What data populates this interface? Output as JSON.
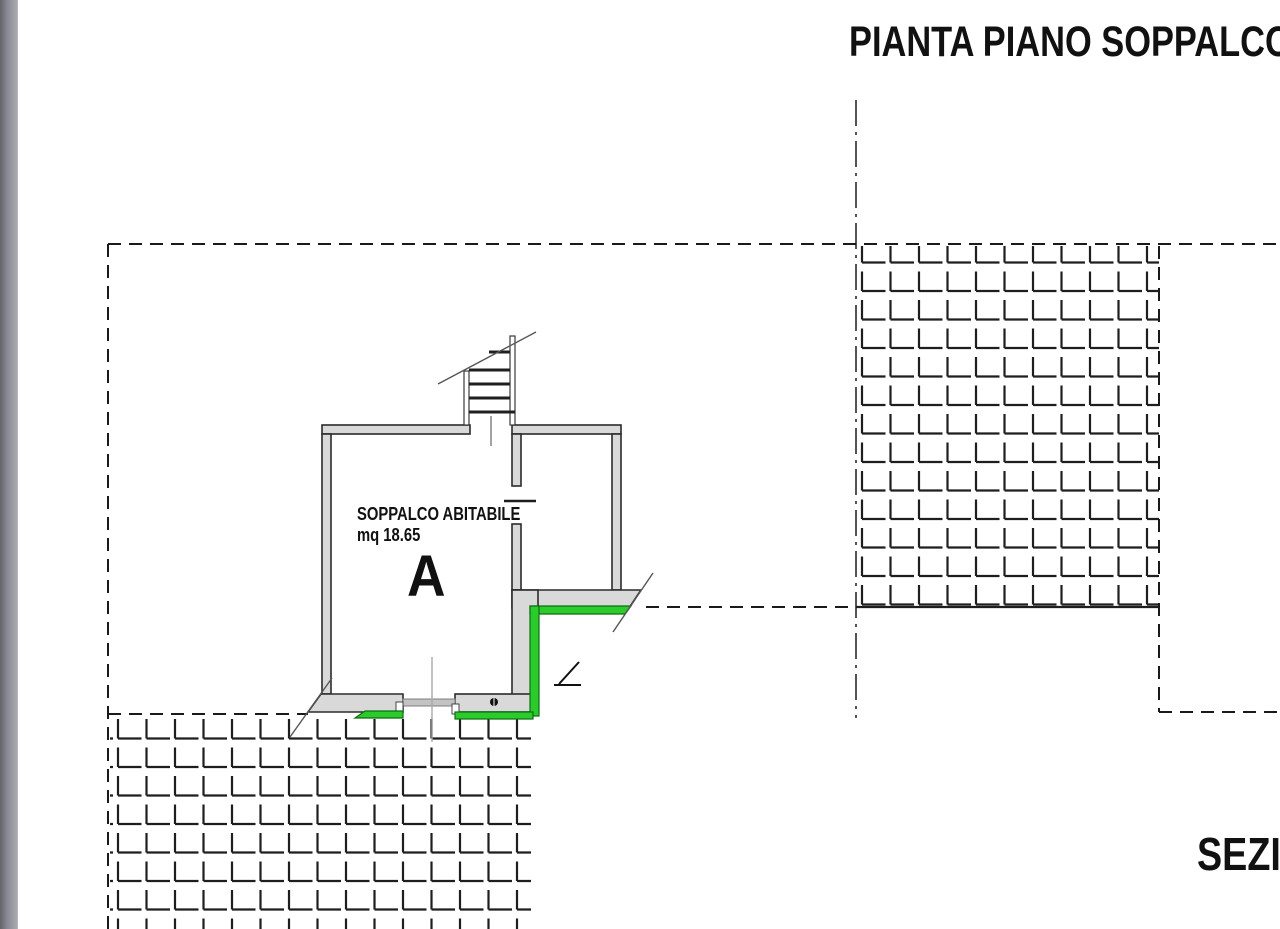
{
  "drawing": {
    "title": "PIANTA PIANO SOPPALCO",
    "section_title_partial": "SEZIO",
    "room_a": {
      "label": "SOPPALCO ABITABILE",
      "area": "mq 18.65",
      "letter": "A"
    }
  },
  "colors": {
    "wall_fill": "#d9d9d9",
    "wall_stroke": "#2b2b2b",
    "highlight_green": "#2acb2a",
    "green_stroke": "#0e6e12",
    "line_dark": "#1a1a1a",
    "sidebar_gray": "#8c8d96"
  }
}
